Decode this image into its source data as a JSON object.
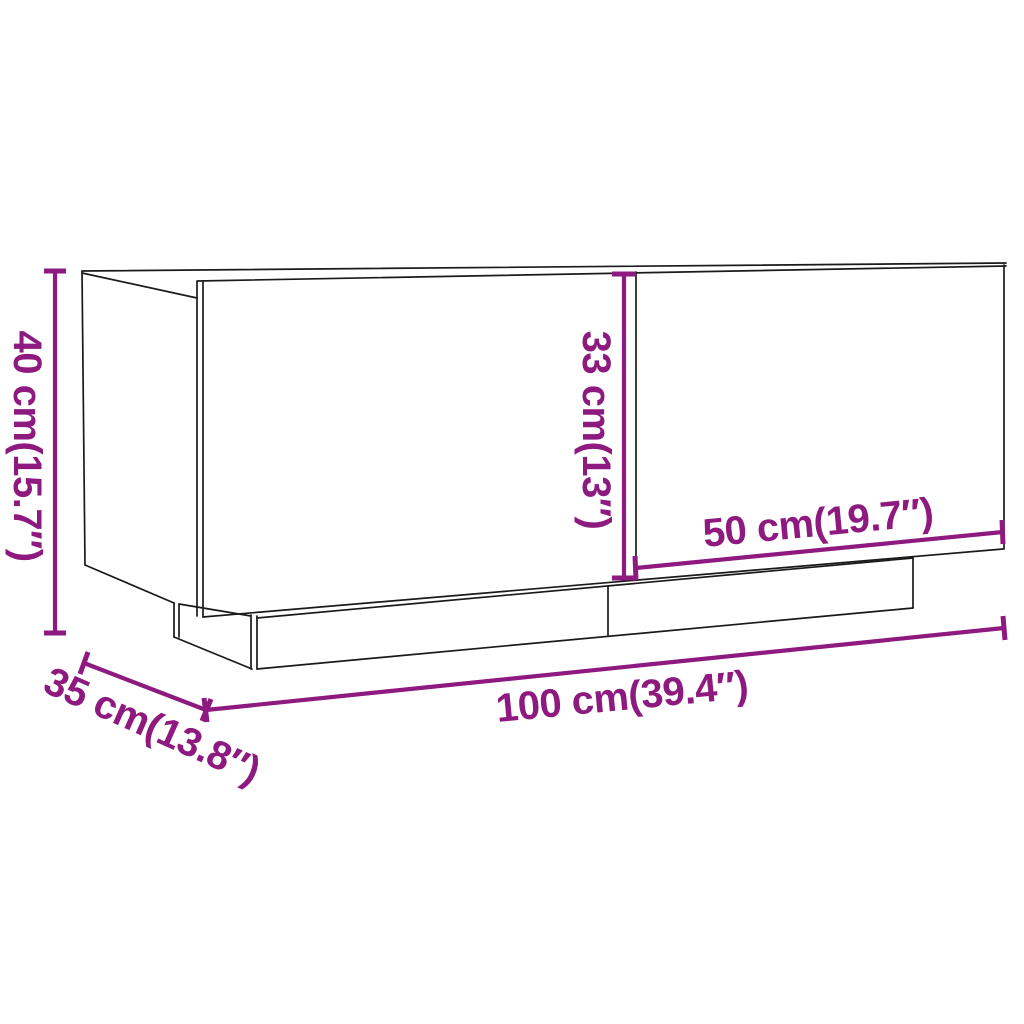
{
  "figure": {
    "type": "product-dimension-diagram",
    "subject": "TV cabinet with two doors on recessed plinth base",
    "background_color": "#ffffff",
    "outline_color": "#1a1a1a",
    "dimension_color": "#8e1a80",
    "dimensions": {
      "height": {
        "label": "40 cm(15.7″)",
        "cm": 40,
        "inches": 15.7,
        "orientation": "vertical-left"
      },
      "inner_height": {
        "label": "33 cm(13″)",
        "cm": 33,
        "inches": 13,
        "orientation": "vertical-inside"
      },
      "door_width": {
        "label": "50 cm(19.7″)",
        "cm": 50,
        "inches": 19.7,
        "orientation": "along-right-door"
      },
      "width": {
        "label": "100 cm(39.4″)",
        "cm": 100,
        "inches": 39.4,
        "orientation": "along-bottom-front"
      },
      "depth": {
        "label": "35 cm(13.8″)",
        "cm": 35,
        "inches": 13.8,
        "orientation": "along-bottom-left-depth"
      }
    }
  }
}
